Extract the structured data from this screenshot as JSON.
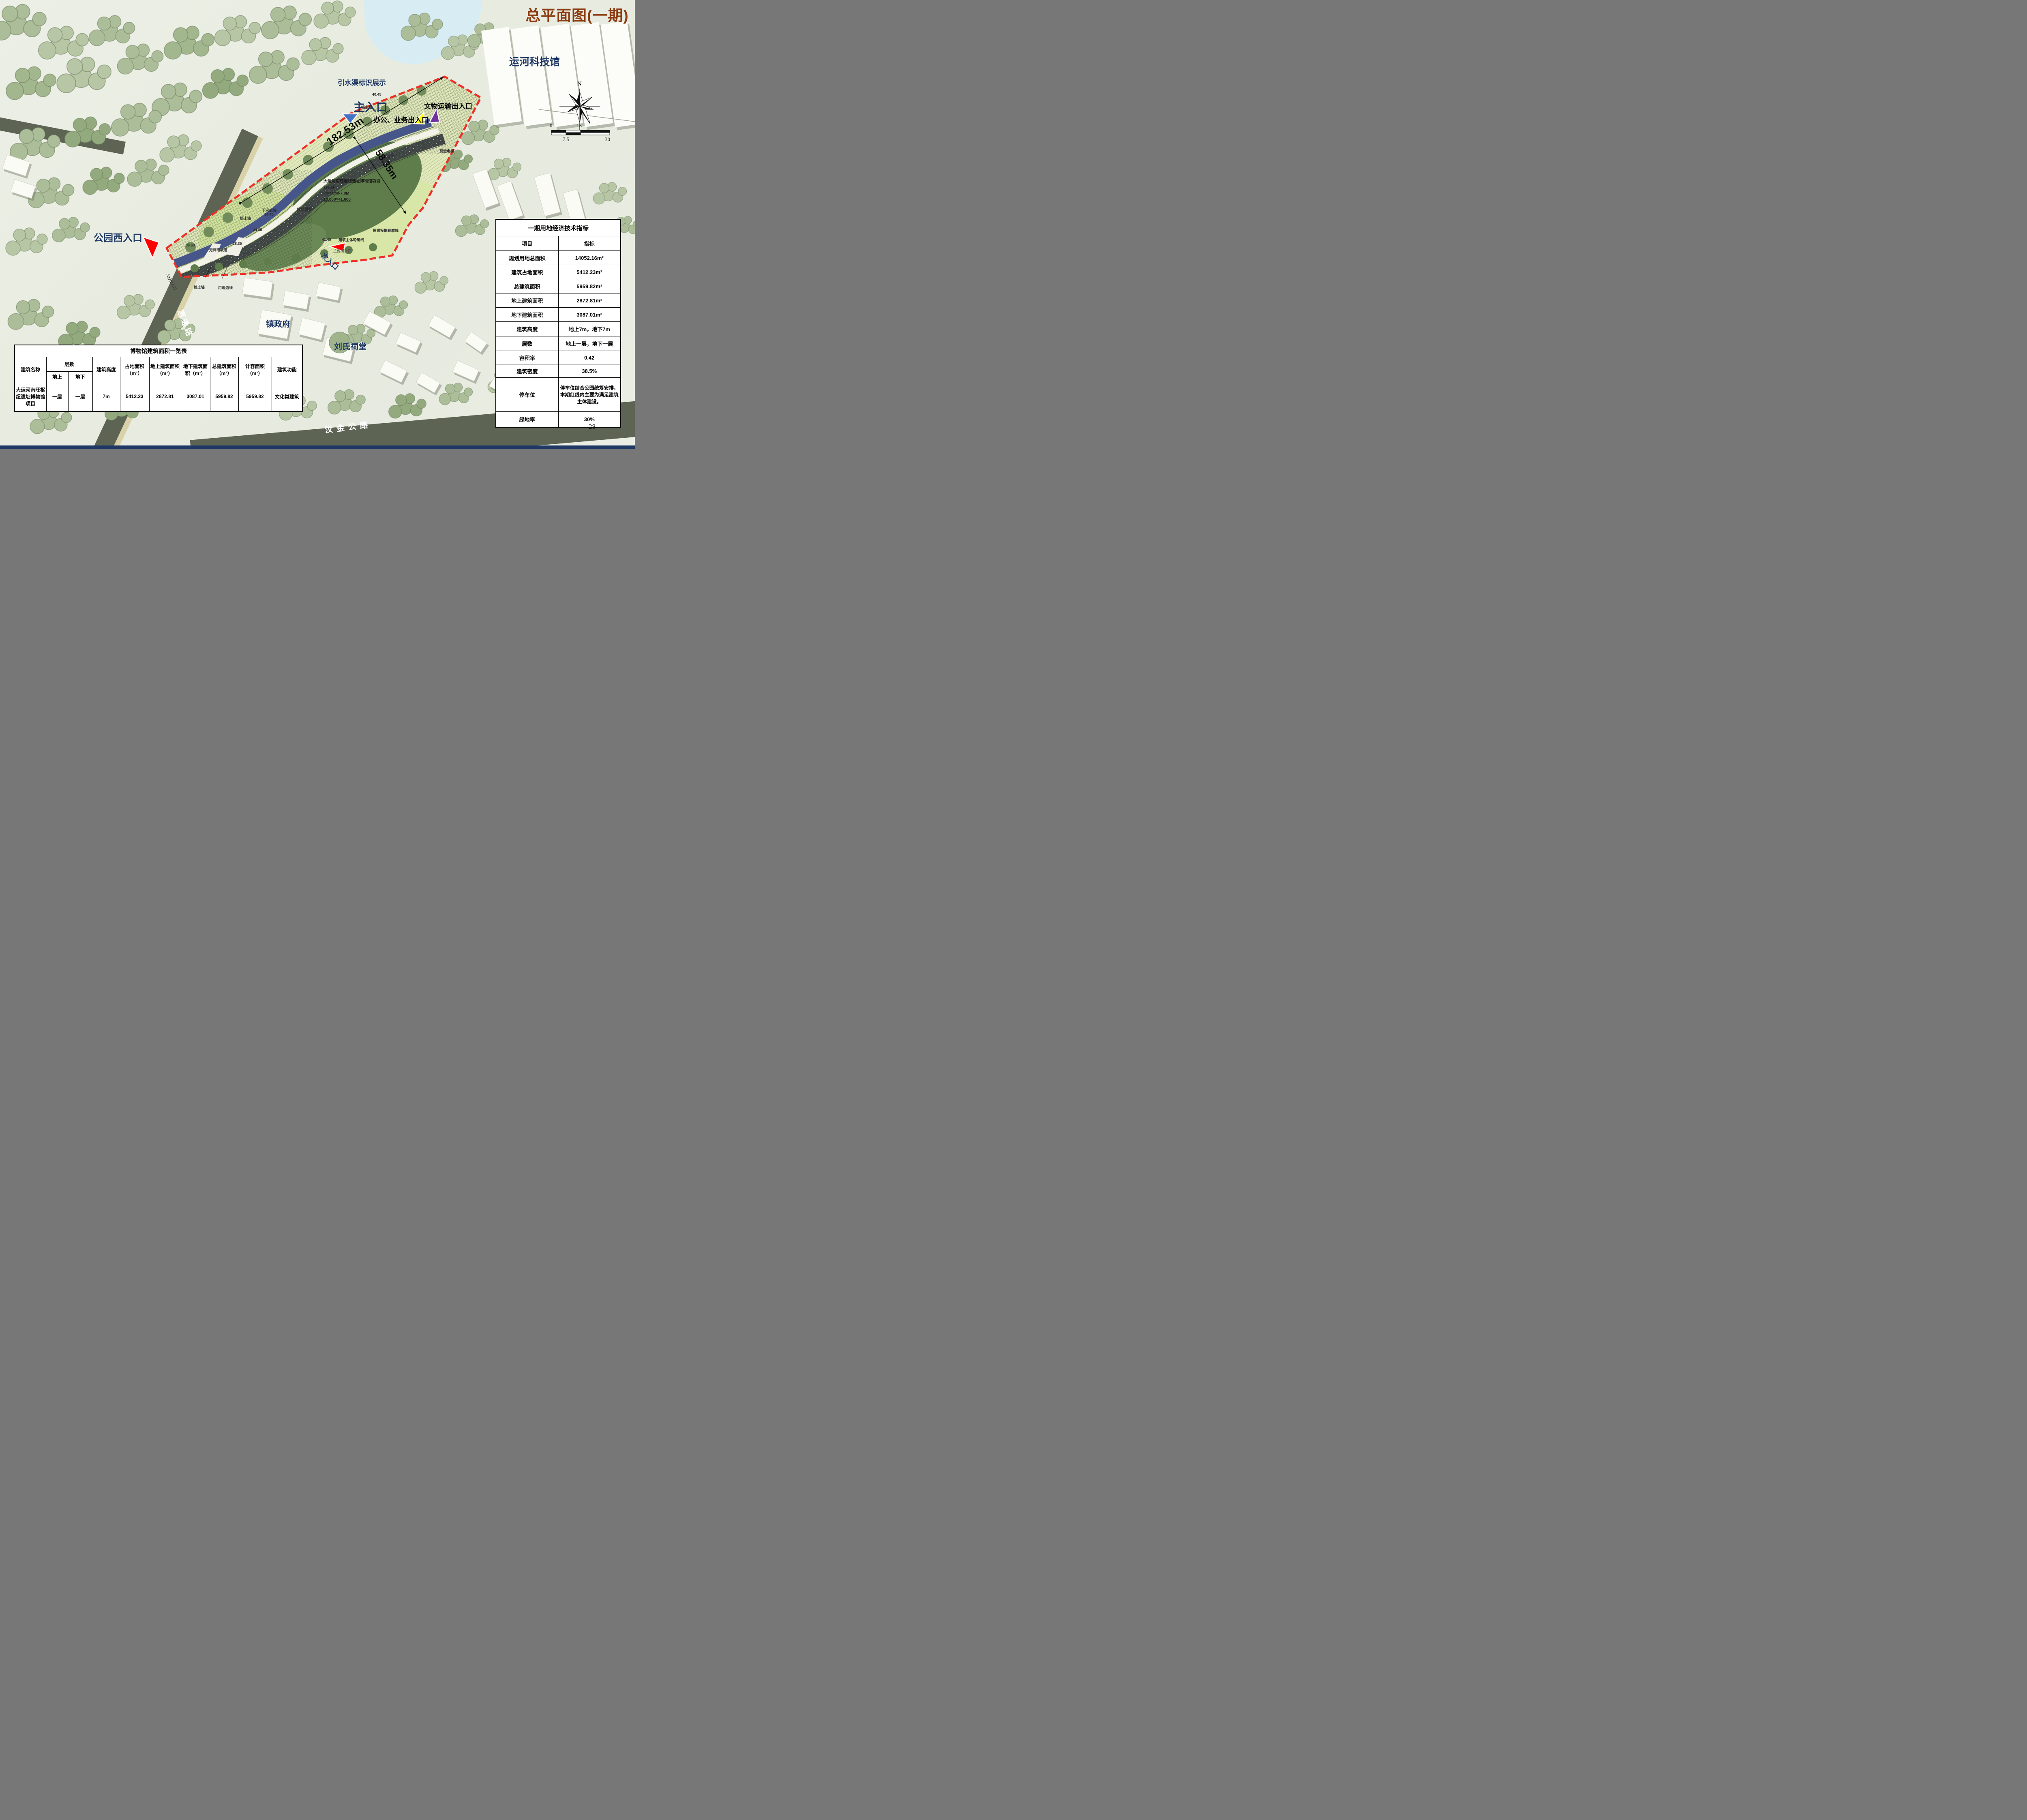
{
  "header": {
    "title": "总平面图(一期)",
    "title_color": "#8c3a10"
  },
  "page": {
    "number": "28",
    "footer_color": "#1f3864"
  },
  "compass": {
    "north": "N",
    "ticks": [
      "0",
      "7.5",
      "15",
      "30"
    ]
  },
  "landmarks": {
    "science_museum": "运河科技馆",
    "town_government": "镇政府",
    "liu_ancestral_hall": "刘氏祠堂",
    "huitong_road": "惠通路",
    "wenjin_highway": "汶金公路"
  },
  "entrances": {
    "channel_sign": "引水渠标识展示",
    "main": "主入口",
    "office_business": "办公、业务出入口",
    "relic_transport": "文物运输出入口",
    "park_west": "公园西入口",
    "secondary": "次入口",
    "pedestrian": "人行出入口"
  },
  "marker_colors": {
    "main": "#4472c4",
    "office_business": "#ffff00",
    "relic_transport": "#7030a0",
    "park_west": "#ff0000",
    "secondary": "#ff0000"
  },
  "dimensions": {
    "frontage": "182.53m",
    "depth": "58.35m"
  },
  "site_block": {
    "project": "大运河南旺枢纽遗址博物馆项目",
    "floors": "1F/-1F",
    "height": "H=7.0M/-7.0M",
    "datum": "±0.000=41.600"
  },
  "plan_labels": {
    "fire_lane": "消防车道",
    "freight_elevator": "货运电梯",
    "retaining_wall": "挡土墙",
    "boundary_line": "用地边线",
    "sunken_courtyard": "下沉庭院",
    "green_roof": "绿化屋面",
    "roof_outline": "屋顶投影轮廓线",
    "building_outline": "建筑主体轮廓线",
    "main_exit": "主要出入口",
    "barrier_free_ramp": "无障碍坡道",
    "elev_4145": "41.45",
    "elev_4045": "40.45",
    "elev_3960": "39.60",
    "elev_3835": "38.35",
    "elev_3445": "34.45"
  },
  "indicator_table": {
    "title": "一期用地经济技术指标",
    "col_item": "项目",
    "col_value": "指标",
    "rows": [
      [
        "规划用地总面积",
        "14052.16m²"
      ],
      [
        "建筑占地面积",
        "5412.23m²"
      ],
      [
        "总建筑面积",
        "5959.82m²"
      ],
      [
        "地上建筑面积",
        "2872.81m²"
      ],
      [
        "地下建筑面积",
        "3087.01m²"
      ],
      [
        "建筑高度",
        "地上7m，地下7m"
      ],
      [
        "层数",
        "地上一层，地下一层"
      ],
      [
        "容积率",
        "0.42"
      ],
      [
        "建筑密度",
        "38.5%"
      ],
      [
        "停车位",
        "停车位结合公园统筹安排，本期红线内主要为满足建筑主体建设。"
      ],
      [
        "绿地率",
        "30%"
      ]
    ]
  },
  "area_table": {
    "title": "博物馆建筑面积一览表",
    "h_name": "建筑名称",
    "h_floors": "层数",
    "h_above": "地上",
    "h_below": "地下",
    "h_height": "建筑高度",
    "h_footprint": "占地面积（m²）",
    "h_above_area": "地上建筑面积（m²）",
    "h_below_area": "地下建筑面积（m²）",
    "h_total_area": "总建筑面积（m²）",
    "h_capacity_area": "计容面积（m²）",
    "h_function": "建筑功能",
    "row": {
      "name": "大运河南旺枢纽遗址博物馆项目",
      "above": "一层",
      "below": "一层",
      "height": "7m",
      "footprint": "5412.23",
      "above_area": "2872.81",
      "below_area": "3087.01",
      "total_area": "5959.82",
      "capacity_area": "5959.82",
      "function": "文化类建筑"
    }
  }
}
